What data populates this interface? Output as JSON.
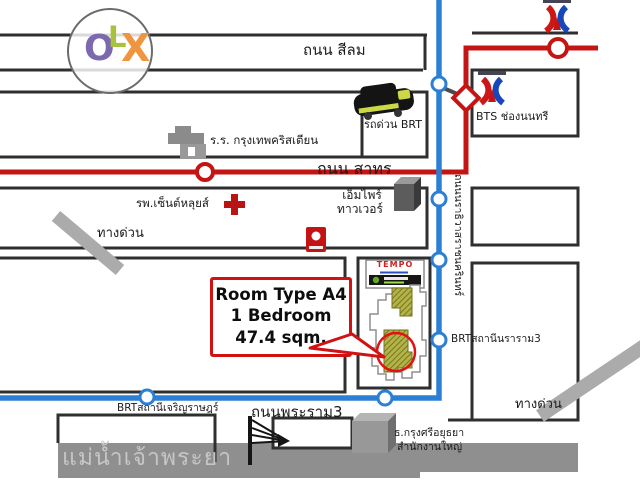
{
  "watermark": {
    "o": "O",
    "l": "L",
    "x": "X"
  },
  "roads": {
    "silom": "ถนน สีลม",
    "sathorn": "ถนน สาทร",
    "rama3": "ถนนพระราม3",
    "naradhiwas": "ถนนนราธิวาสราชนครินทร์",
    "expressway_left": "ทางด่วน",
    "expressway_right": "ทางด่วน"
  },
  "transit": {
    "brt_express_label": "รถด่วน BRT",
    "bts_station": "BTS ช่องนนทรี",
    "brt_station_nararam": "BRTสถานีนราราม3",
    "brt_station_charoenrat": "BRTสถานีเจริญราษฎร์"
  },
  "landmarks": {
    "school": "ร.ร. กรุงเทพคริสเตียน",
    "hospital": "รพ.เซ็นต์หลุยส์",
    "empire_tower_line1": "เอ็มไพร์",
    "empire_tower_line2": "ทาวเวอร์",
    "bank_line1": "ธ.กรุงศรีอยุธยา",
    "bank_line2": "สำนักงานใหญ่",
    "river": "แม่น้ำเจ้าพระยา",
    "project_sign": "TEMPO"
  },
  "callout": {
    "line1": "Room Type A4",
    "line2": "1 Bedroom",
    "line3": "47.4 sqm."
  },
  "colors": {
    "brt_blue": "#2b7fd4",
    "bts_red": "#c41414",
    "road_dark": "#2f2f2f",
    "river_gray": "#8f8f8f",
    "expressway_gray": "#ababab",
    "unit_khaki": "#b3b34a",
    "callout_red": "#d21212",
    "olx_o": "#7b68ae",
    "olx_l": "#a9c23d",
    "olx_x": "#f0953f"
  },
  "icons": [
    "olx-logo",
    "brt-bus-icon",
    "school-icon",
    "hospital-cross-icon",
    "shrine-icon",
    "bts-logo-icon",
    "empire-tower-icon",
    "bank-building-icon",
    "bridge-icon",
    "floorplan-icon",
    "expressway-ramp-icon",
    "station-dot-icon",
    "interchange-diamond-icon"
  ]
}
